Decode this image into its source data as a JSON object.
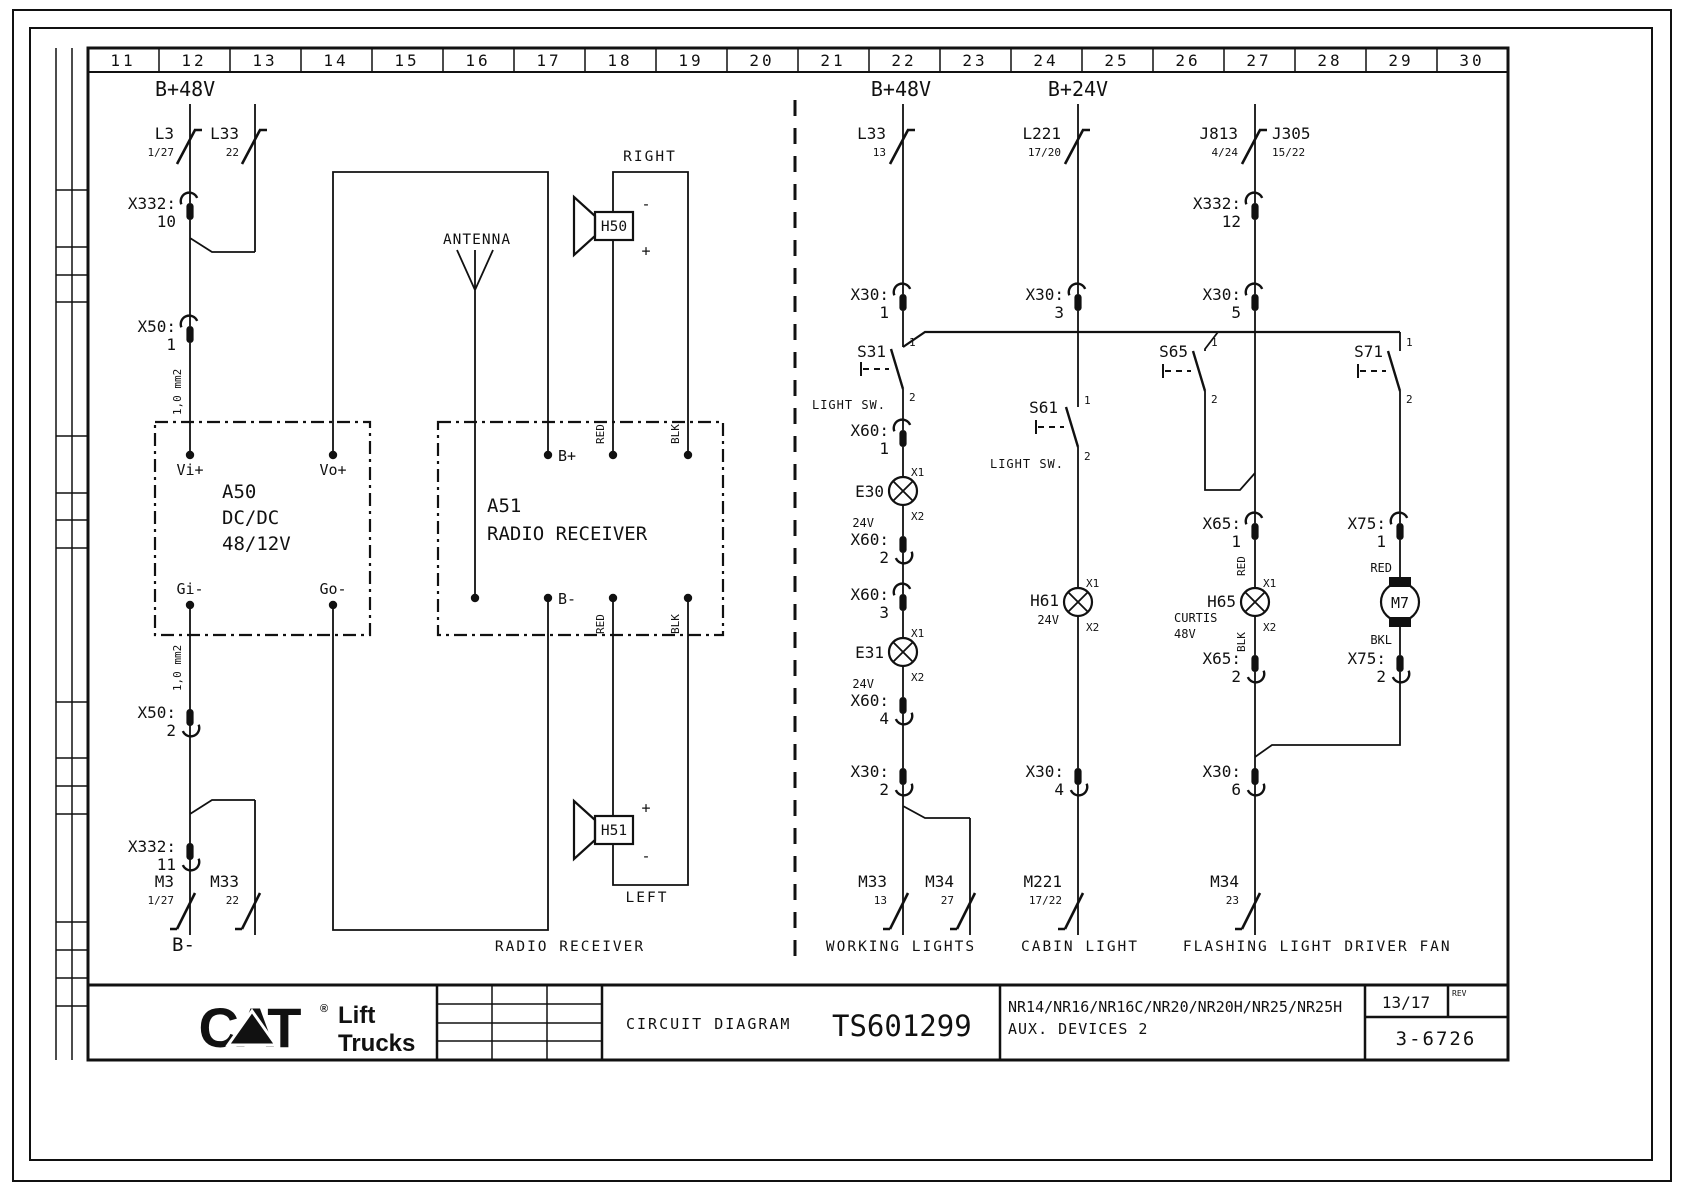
{
  "frame": {
    "ruler_cells": [
      "11",
      "12",
      "13",
      "14",
      "15",
      "16",
      "17",
      "18",
      "19",
      "20",
      "21",
      "22",
      "23",
      "24",
      "25",
      "26",
      "27",
      "28",
      "29",
      "30"
    ]
  },
  "radio_section": {
    "supply_label": "B+48V",
    "ground_label": "B-",
    "footer_label": "RADIO RECEIVER",
    "antenna_label": "ANTENNA",
    "wire_gauge": "1,0 mm2",
    "contacts": {
      "l3": {
        "ref": "L3",
        "pin": "1/27"
      },
      "l33": {
        "ref": "L33",
        "pin": "22"
      },
      "m3": {
        "ref": "M3",
        "pin": "1/27"
      },
      "m33": {
        "ref": "M33",
        "pin": "22"
      }
    },
    "connectors": {
      "x332_10": {
        "ref": "X332:",
        "pin": "10"
      },
      "x50_1": {
        "ref": "X50:",
        "pin": "1"
      },
      "x50_2": {
        "ref": "X50:",
        "pin": "2"
      },
      "x332_11": {
        "ref": "X332:",
        "pin": "11"
      }
    },
    "dcdc": {
      "ref": "A50",
      "line1": "DC/DC",
      "line2": "48/12V",
      "vi": "Vi+",
      "vo": "Vo+",
      "gi": "Gi-",
      "go": "Go-"
    },
    "receiver": {
      "ref": "A51",
      "name": "RADIO RECEIVER",
      "b_plus": "B+",
      "b_minus": "B-",
      "red": "RED",
      "blk": "BLK"
    },
    "speaker_right": {
      "position": "RIGHT",
      "ref": "H50",
      "minus": "-",
      "plus": "+"
    },
    "speaker_left": {
      "position": "LEFT",
      "ref": "H51",
      "minus": "-",
      "plus": "+"
    }
  },
  "aux_section": {
    "supply48": "B+48V",
    "supply24": "B+24V",
    "working_lights": {
      "footer": "WORKING LIGHTS",
      "contact_top": {
        "ref": "L33",
        "pin": "13"
      },
      "x30_1": {
        "ref": "X30:",
        "pin": "1"
      },
      "s31": {
        "ref": "S31",
        "p1": "1",
        "p2": "2",
        "label": "LIGHT SW."
      },
      "x60_1": {
        "ref": "X60:",
        "pin": "1"
      },
      "e30": {
        "ref": "E30",
        "x1": "X1",
        "x2": "X2",
        "volt": "24V"
      },
      "x60_2": {
        "ref": "X60:",
        "pin": "2"
      },
      "x60_3": {
        "ref": "X60:",
        "pin": "3"
      },
      "e31": {
        "ref": "E31",
        "x1": "X1",
        "x2": "X2",
        "volt": "24V"
      },
      "x60_4": {
        "ref": "X60:",
        "pin": "4"
      },
      "x30_2": {
        "ref": "X30:",
        "pin": "2"
      },
      "m33": {
        "ref": "M33",
        "pin": "13"
      },
      "m34": {
        "ref": "M34",
        "pin": "27"
      }
    },
    "cabin_light": {
      "footer": "CABIN LIGHT",
      "contact_top": {
        "ref": "L221",
        "pin": "17/20"
      },
      "x30_3": {
        "ref": "X30:",
        "pin": "3"
      },
      "s61": {
        "ref": "S61",
        "p1": "1",
        "p2": "2",
        "label": "LIGHT SW."
      },
      "h61": {
        "ref": "H61",
        "volt": "24V",
        "x1": "X1",
        "x2": "X2"
      },
      "x30_4": {
        "ref": "X30:",
        "pin": "4"
      },
      "m221": {
        "ref": "M221",
        "pin": "17/22"
      }
    },
    "flashing_light": {
      "footer": "FLASHING LIGHT",
      "contact_top": {
        "ref": "J813",
        "pin": "4/24",
        "alt_ref": "J305",
        "alt_pin": "15/22"
      },
      "x332_12": {
        "ref": "X332:",
        "pin": "12"
      },
      "x30_5": {
        "ref": "X30:",
        "pin": "5"
      },
      "s65": {
        "ref": "S65",
        "p1": "1",
        "p2": "2"
      },
      "x65_1": {
        "ref": "X65:",
        "pin": "1"
      },
      "wire_red": "RED",
      "wire_blk": "BLK",
      "h65": {
        "ref": "H65",
        "maker": "CURTIS",
        "volt": "48V",
        "x1": "X1",
        "x2": "X2"
      },
      "x65_2": {
        "ref": "X65:",
        "pin": "2"
      },
      "x30_6": {
        "ref": "X30:",
        "pin": "6"
      },
      "m34": {
        "ref": "M34",
        "pin": "23"
      }
    },
    "driver_fan": {
      "footer": "DRIVER FAN",
      "s71": {
        "ref": "S71",
        "p1": "1",
        "p2": "2"
      },
      "x75_1": {
        "ref": "X75:",
        "pin": "1"
      },
      "wire_red": "RED",
      "wire_bkl": "BKL",
      "m7": {
        "ref": "M7"
      },
      "x75_2": {
        "ref": "X75:",
        "pin": "2"
      }
    }
  },
  "title_block": {
    "brand": {
      "cat": "CAT",
      "reg": "®",
      "lift": "Lift",
      "trucks": "Trucks"
    },
    "doc_type": "CIRCUIT DIAGRAM",
    "doc_number": "TS601299",
    "models": "NR14/NR16/NR16C/NR20/NR20H/NR25/NR25H",
    "subtitle": "AUX. DEVICES 2",
    "sheet": "13/17",
    "rev_label": "REV",
    "drawing_code": "3-6726"
  }
}
